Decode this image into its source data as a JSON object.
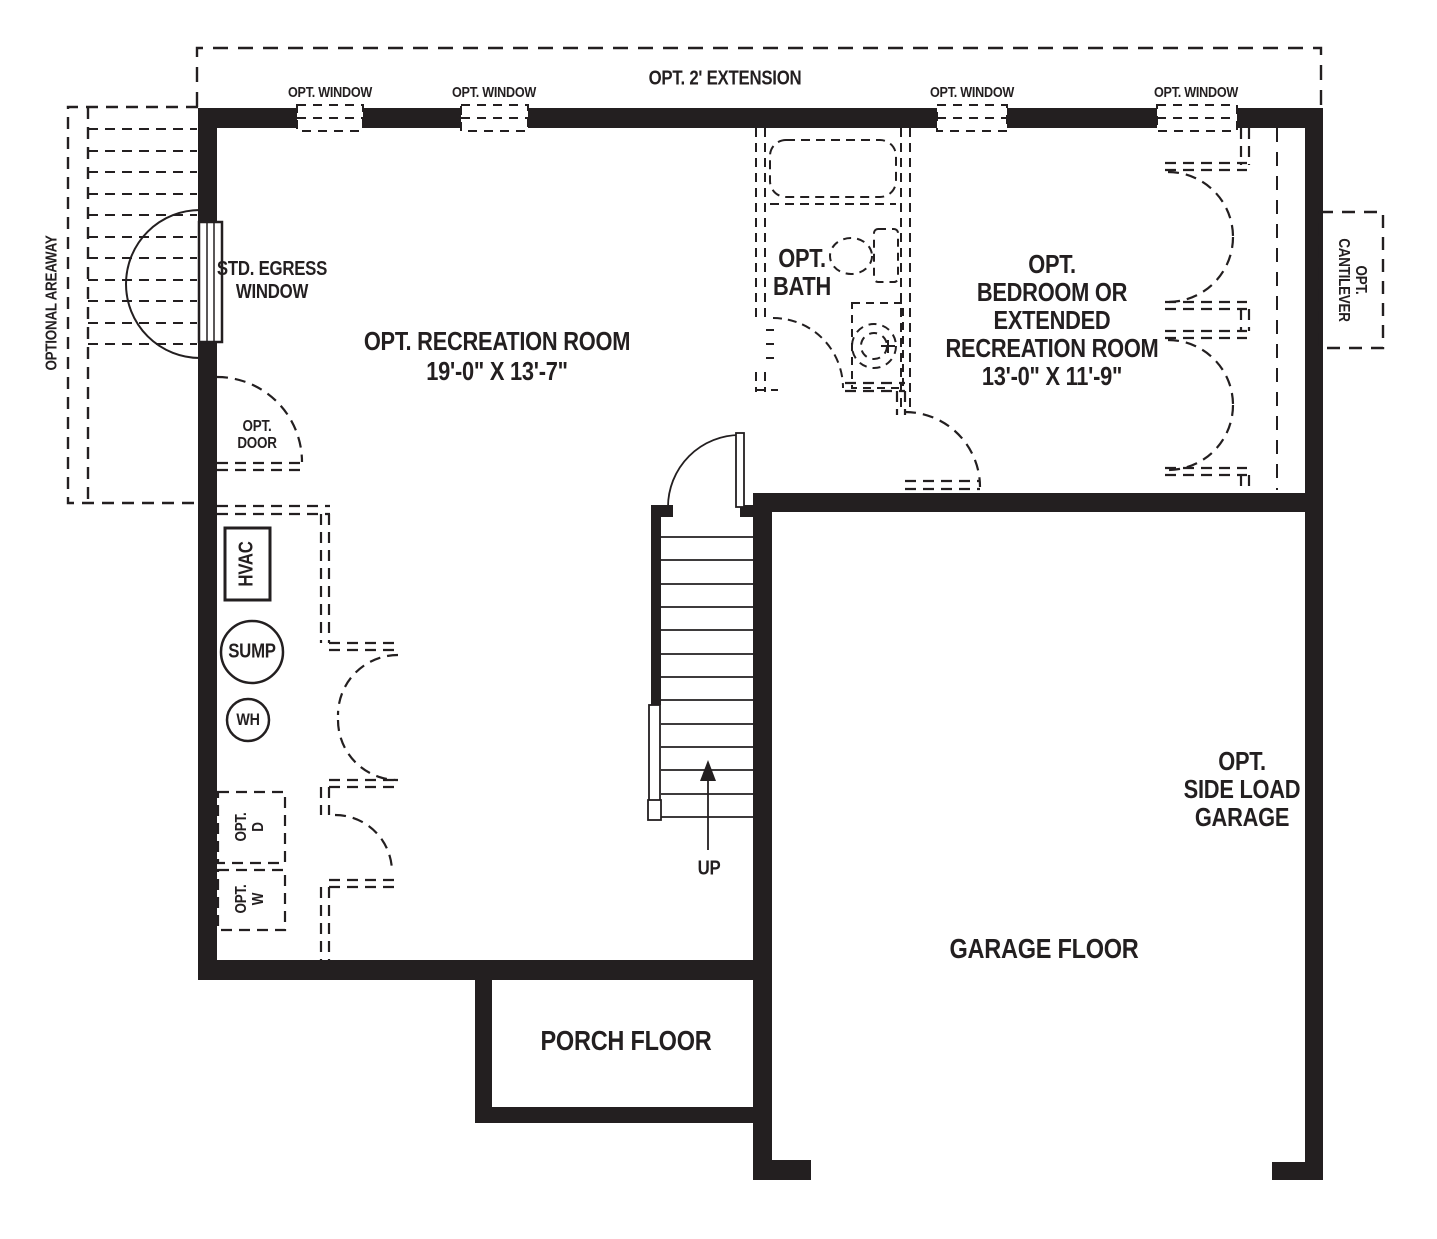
{
  "floor_plan": {
    "colors": {
      "line": "#231f20",
      "background": "#ffffff"
    },
    "extension_label": "OPT. 2' EXTENSION",
    "window_labels": [
      "OPT. WINDOW",
      "OPT. WINDOW",
      "OPT. WINDOW",
      "OPT. WINDOW"
    ],
    "areaway_label": "OPTIONAL AREAWAY",
    "egress_window": {
      "line1": "STD. EGRESS",
      "line2": "WINDOW"
    },
    "recreation_room": {
      "name": "OPT. RECREATION ROOM",
      "dimensions": "19'-0\" X 13'-7\""
    },
    "opt_door": {
      "line1": "OPT.",
      "line2": "DOOR"
    },
    "mechanical": {
      "hvac": "HVAC",
      "sump": "SUMP",
      "water_heater": "WH"
    },
    "laundry": {
      "dryer": {
        "line1": "OPT.",
        "line2": "D"
      },
      "washer": {
        "line1": "OPT.",
        "line2": "W"
      }
    },
    "bath": {
      "line1": "OPT.",
      "line2": "BATH"
    },
    "bedroom": {
      "line1": "OPT.",
      "line2": "BEDROOM OR",
      "line3": "EXTENDED",
      "line4": "RECREATION ROOM",
      "dimensions": "13'-0\" X 11'-9\""
    },
    "cantilever": {
      "line1": "OPT.",
      "line2": "CANTILEVER"
    },
    "stairs": {
      "direction_label": "UP"
    },
    "garage": {
      "line1": "OPT.",
      "line2": "SIDE LOAD",
      "line3": "GARAGE",
      "floor_label": "GARAGE FLOOR"
    },
    "porch": {
      "floor_label": "PORCH FLOOR"
    }
  }
}
